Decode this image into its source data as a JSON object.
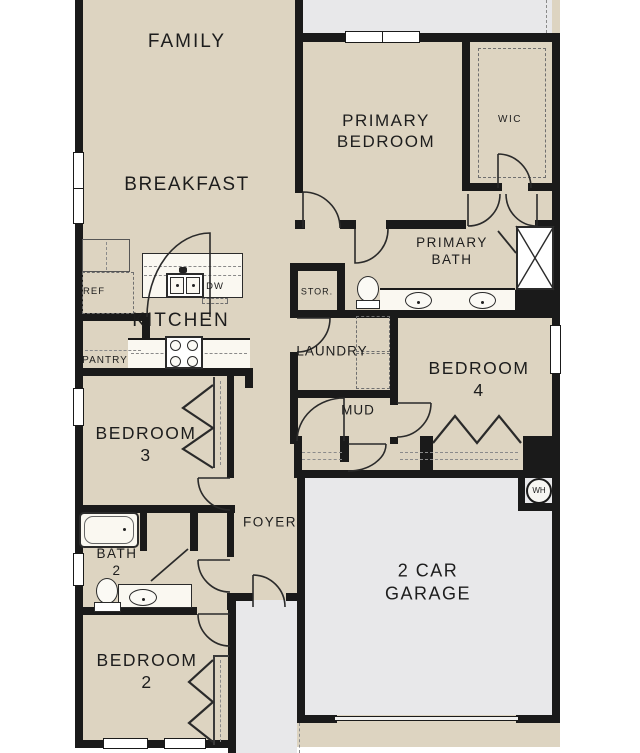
{
  "colors": {
    "floor": "#ddd4c1",
    "patio": "#e8e8ea",
    "wall": "#1a1a1a",
    "fixture": "#faf8f1"
  },
  "rooms": {
    "family": {
      "label": "FAMILY"
    },
    "breakfast": {
      "label": "BREAKFAST"
    },
    "primary_bedroom": {
      "label": "PRIMARY\nBEDROOM"
    },
    "wic": {
      "label": "WIC"
    },
    "primary_bath": {
      "label": "PRIMARY\nBATH"
    },
    "storage": {
      "label": "STOR."
    },
    "kitchen": {
      "label": "KITCHEN"
    },
    "pantry": {
      "label": "PANTRY"
    },
    "laundry": {
      "label": "LAUNDRY"
    },
    "bedroom4": {
      "label": "BEDROOM 4"
    },
    "mud": {
      "label": "MUD"
    },
    "bedroom3": {
      "label": "BEDROOM 3"
    },
    "foyer": {
      "label": "FOYER"
    },
    "bath2": {
      "label": "BATH 2"
    },
    "bedroom2": {
      "label": "BEDROOM 2"
    },
    "garage": {
      "label": "2 CAR\nGARAGE"
    }
  },
  "fixtures": {
    "refrigerator": {
      "label": "REF"
    },
    "dishwasher": {
      "label": "DW"
    },
    "water_heater": {
      "label": "WH"
    }
  }
}
